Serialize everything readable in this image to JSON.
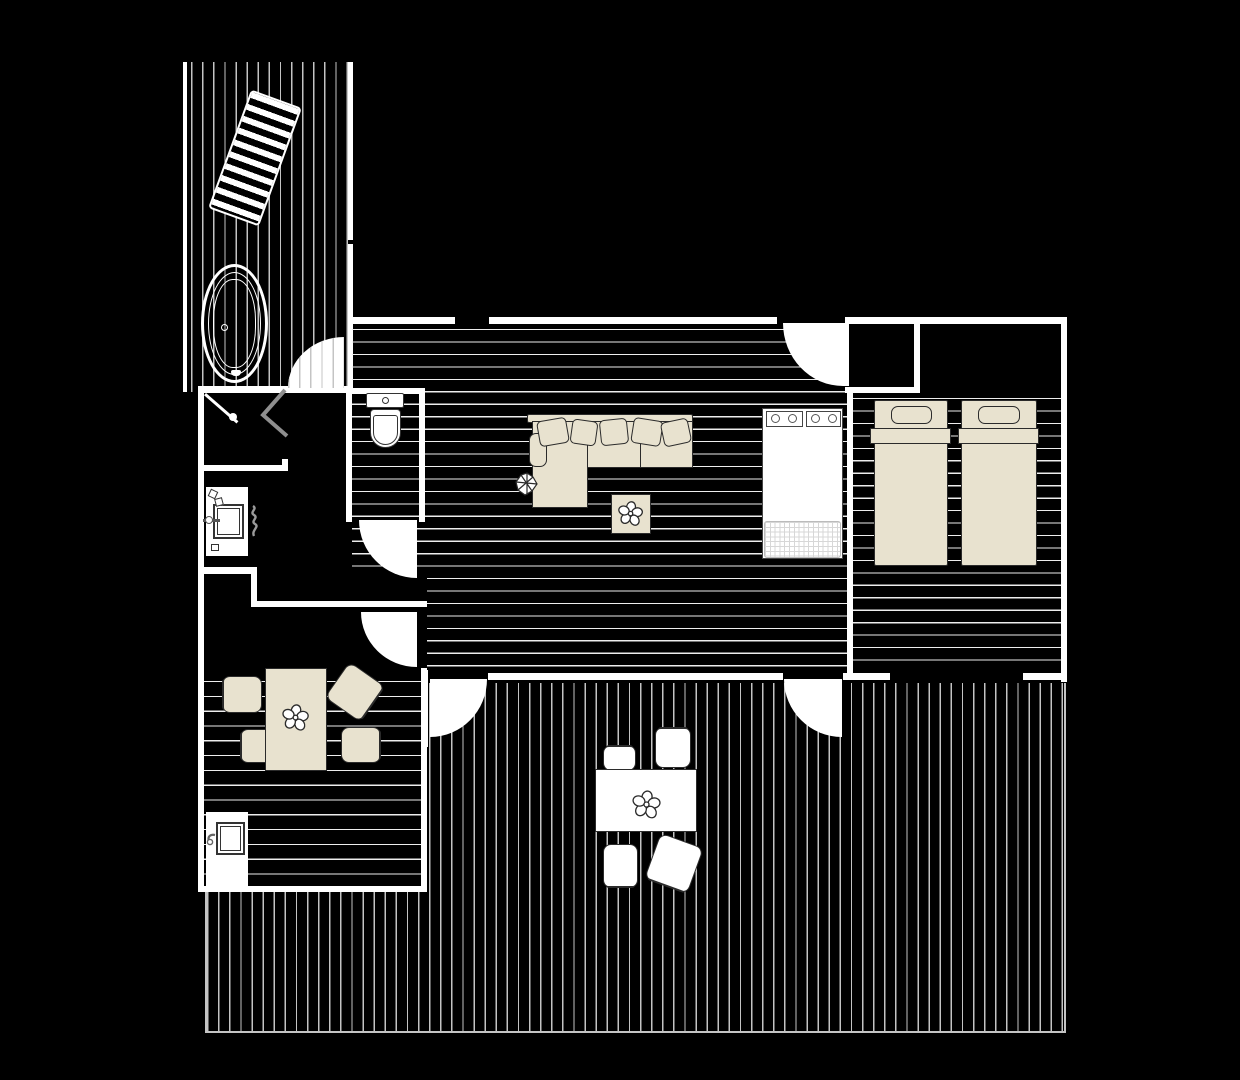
{
  "drawing": {
    "type": "architectural-floor-plan",
    "colors": {
      "bg": "#000000",
      "wall": "#ffffff",
      "floorline": "#ededed",
      "deckline": "#c4c4c4",
      "furn": "#e8e2cf",
      "line": "#2b2b2b",
      "glass": "#8f8f8f"
    },
    "areas": [
      {
        "name": "upper-deck",
        "features": [
          "lounge-chair",
          "bathtub"
        ]
      },
      {
        "name": "bathroom",
        "features": [
          "corner-shower",
          "vanity-sink",
          "towel"
        ]
      },
      {
        "name": "wc-niche",
        "features": [
          "toilet"
        ]
      },
      {
        "name": "living-room",
        "features": [
          "corner-sofa",
          "cushions",
          "plant",
          "coffee-table",
          "kitchen-unit-4-burners",
          "kitchen-mat"
        ]
      },
      {
        "name": "bedroom",
        "features": [
          "closet",
          "single-bed",
          "single-bed"
        ]
      },
      {
        "name": "dining-room",
        "features": [
          "dining-table",
          "four-chairs",
          "flowers",
          "kitchen-sink-counter"
        ]
      },
      {
        "name": "lower-deck",
        "features": [
          "outdoor-table",
          "four-outdoor-chairs",
          "flowers"
        ]
      }
    ],
    "doors": [
      {
        "name": "deck-door-upper"
      },
      {
        "name": "wc-door"
      },
      {
        "name": "hall-to-dining-door"
      },
      {
        "name": "bedroom-door"
      },
      {
        "name": "living-to-deck-door"
      },
      {
        "name": "dining-to-deck-door"
      }
    ],
    "windows": [
      {
        "name": "living-north-window"
      },
      {
        "name": "bedroom-south-window"
      }
    ]
  }
}
